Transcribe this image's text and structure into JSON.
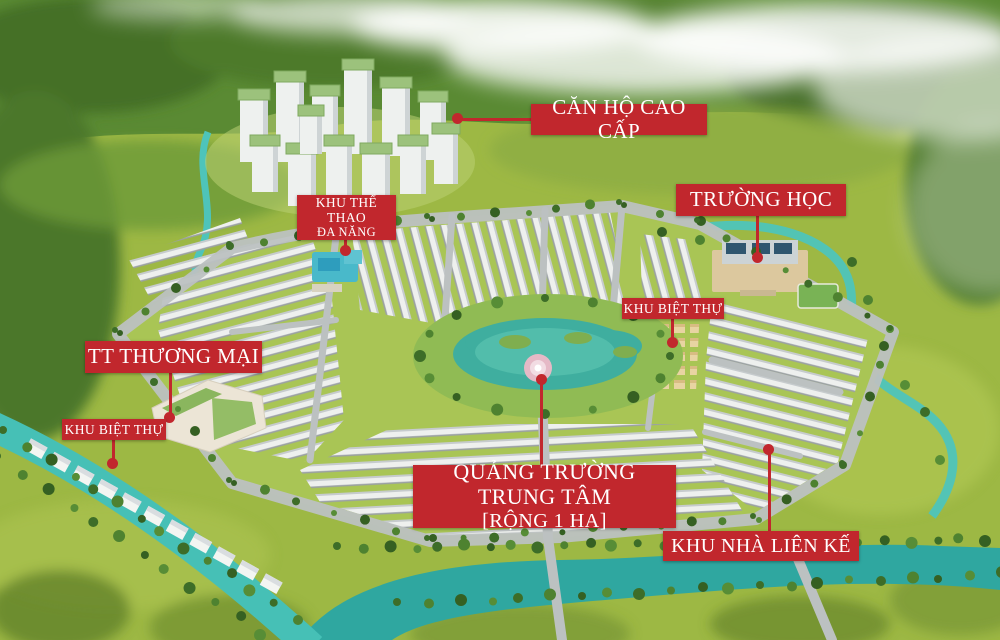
{
  "labels": {
    "apartments": {
      "text": "CĂN HỘ CAO CẤP"
    },
    "school": {
      "text": "TRƯỜNG HỌC"
    },
    "sports_zone": {
      "line1": "KHU THỂ THAO",
      "line2": "ĐA NĂNG"
    },
    "villa_zone_right": {
      "text": "KHU BIỆT THỰ"
    },
    "commercial_center": {
      "text": "TT THƯƠNG MẠI"
    },
    "villa_zone_left": {
      "text": "KHU BIỆT THỰ"
    },
    "central_square": {
      "line1": "QUẢNG TRƯỜNG TRUNG TÂM",
      "line2": "[RỘNG 1 HA]"
    },
    "townhouse_zone": {
      "text": "KHU NHÀ LIÊN KẾ"
    }
  },
  "colors": {
    "label_background": "#c1272d",
    "label_text": "#ffffff",
    "connector": "#c1272d",
    "water": "#46c0b6",
    "river": "#2fa7a0",
    "field_green": "#9db844",
    "hill_green": "#5a8a33",
    "road_grey": "#bcc1c1",
    "tower_roof_green": "#9cc27c"
  }
}
